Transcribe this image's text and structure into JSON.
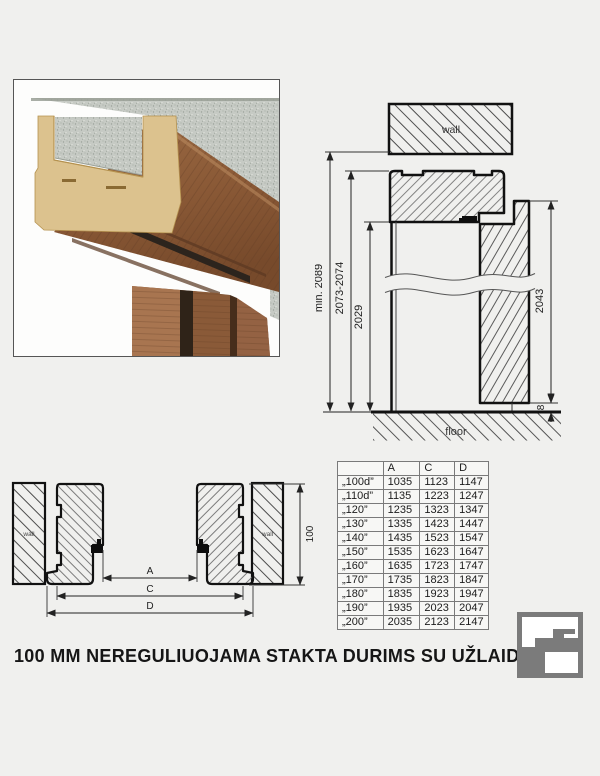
{
  "title": "100 MM NEREGULIUOJAMA STAKTA DURIMS SU UŽLAIDA",
  "vertical_section": {
    "wall_label": "wall",
    "floor_label": "floor",
    "min_opening_height": "min. 2089",
    "frame_height": "2073-2074",
    "clear_height": "2029",
    "leaf_height": "2043",
    "floor_gap": "8"
  },
  "horizontal_section": {
    "wall_label_left": "wall",
    "wall_label_right": "wall",
    "dim_a_label": "A",
    "dim_c_label": "C",
    "dim_d_label": "D",
    "frame_depth": "100"
  },
  "size_table": {
    "headers": [
      "",
      "A",
      "C",
      "D"
    ],
    "rows": [
      {
        "size": "„100d”",
        "a": "1035",
        "c": "1123",
        "d": "1147"
      },
      {
        "size": "„110d”",
        "a": "1135",
        "c": "1223",
        "d": "1247"
      },
      {
        "size": "„120”",
        "a": "1235",
        "c": "1323",
        "d": "1347"
      },
      {
        "size": "„130”",
        "a": "1335",
        "c": "1423",
        "d": "1447"
      },
      {
        "size": "„140”",
        "a": "1435",
        "c": "1523",
        "d": "1547"
      },
      {
        "size": "„150”",
        "a": "1535",
        "c": "1623",
        "d": "1647"
      },
      {
        "size": "„160”",
        "a": "1635",
        "c": "1723",
        "d": "1747"
      },
      {
        "size": "„170”",
        "a": "1735",
        "c": "1823",
        "d": "1847"
      },
      {
        "size": "„180”",
        "a": "1835",
        "c": "1923",
        "d": "1947"
      },
      {
        "size": "„190”",
        "a": "1935",
        "c": "2023",
        "d": "2047"
      },
      {
        "size": "„200”",
        "a": "2035",
        "c": "2123",
        "d": "2147"
      }
    ]
  },
  "colors": {
    "background": "#f0f0ee",
    "line": "#111111",
    "logo_gray": "#7b7b7b",
    "wood": "#8a5a38",
    "mdf": "#dcc28e",
    "concrete": "#c6cac4"
  }
}
